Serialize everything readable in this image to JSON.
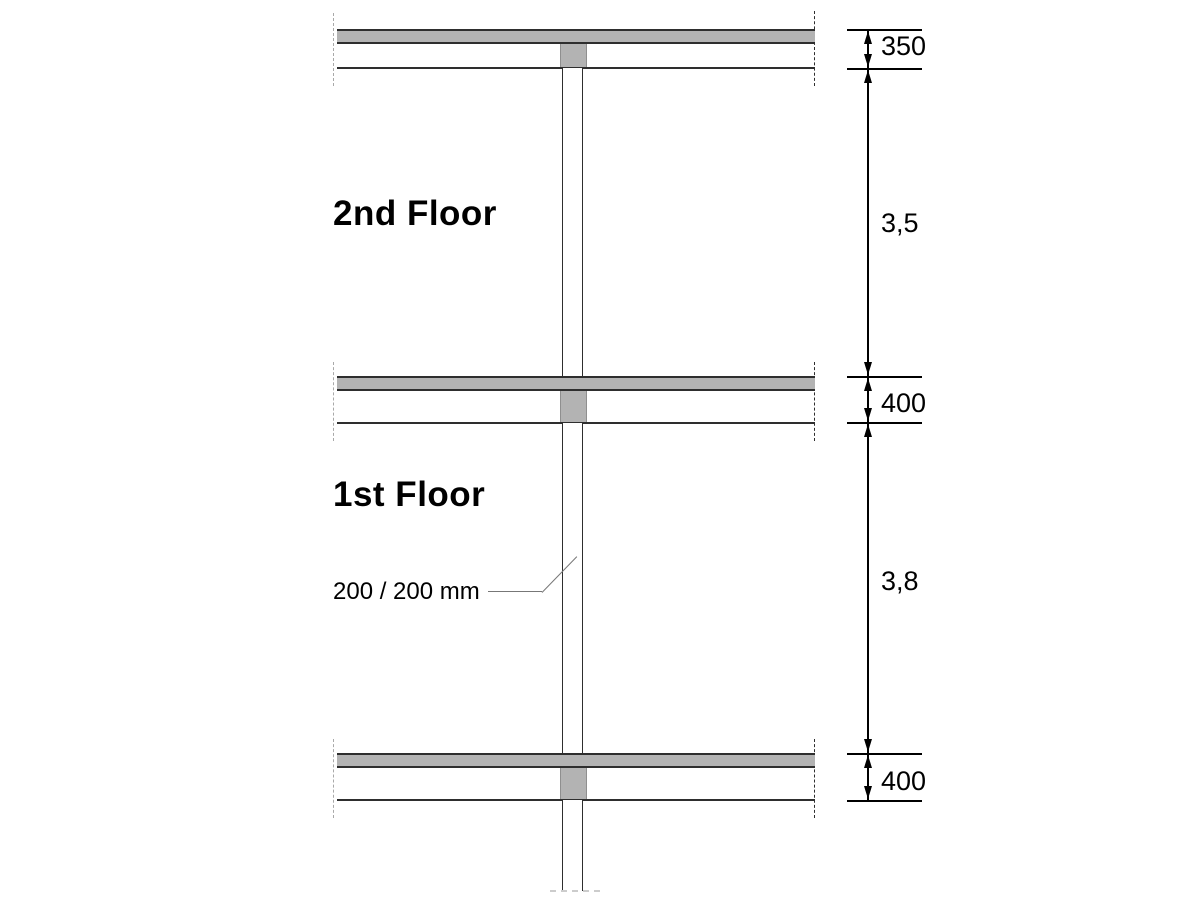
{
  "drawing": {
    "type": "structural-section",
    "floor_labels": [
      {
        "id": "floor-2",
        "label": "2nd Floor"
      },
      {
        "id": "floor-1",
        "label": "1st Floor"
      }
    ],
    "column_annotation": "200 / 200 mm",
    "dimension_labels": {
      "roof_slab_depth": "350",
      "storey_2_height": "3,5",
      "floor_2_slab_depth": "400",
      "storey_1_height": "3,8",
      "floor_1_slab_depth": "400"
    },
    "colors": {
      "background": "#ffffff",
      "slab_fill": "#b3b3b3",
      "line_dark": "#2e2e2e",
      "stub_edge": "#8f8f8f",
      "dash_light": "#a9a9a9",
      "dash_break": "#cccccc",
      "leader": "#777777",
      "dim_color": "#000000"
    }
  }
}
